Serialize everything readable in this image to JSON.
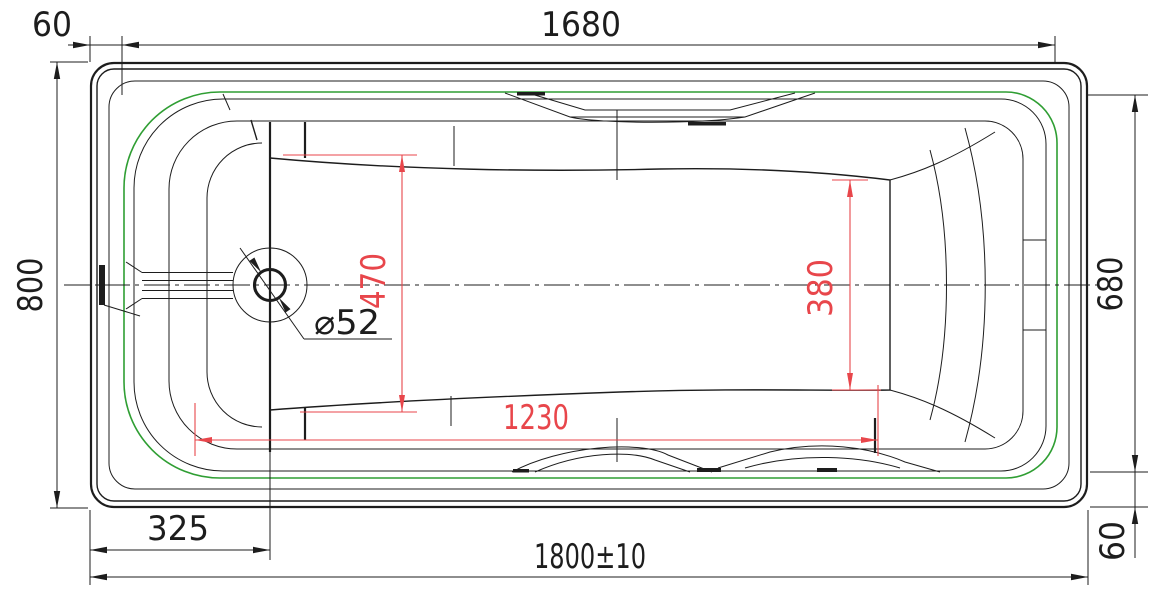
{
  "drawing": {
    "type": "engineering-drawing",
    "subject": "bathtub-top-view",
    "units": "mm",
    "colors": {
      "line_black": "#1d1d1d",
      "contour_green": "#2f9e33",
      "dimension_red": "#e8464b",
      "background": "#ffffff"
    },
    "dimensions": {
      "rim_offset_top_left": "60",
      "rim_length_top": "1680",
      "overall_width": "800",
      "inner_rim_width": "680",
      "rim_offset_bottom_right": "60",
      "drain_center_from_left": "325",
      "overall_length": "1800±10",
      "drain_hole_diameter": "⌀52",
      "basin_floor_width_front": "470",
      "basin_floor_width_rear": "380",
      "basin_floor_length": "1230"
    }
  }
}
